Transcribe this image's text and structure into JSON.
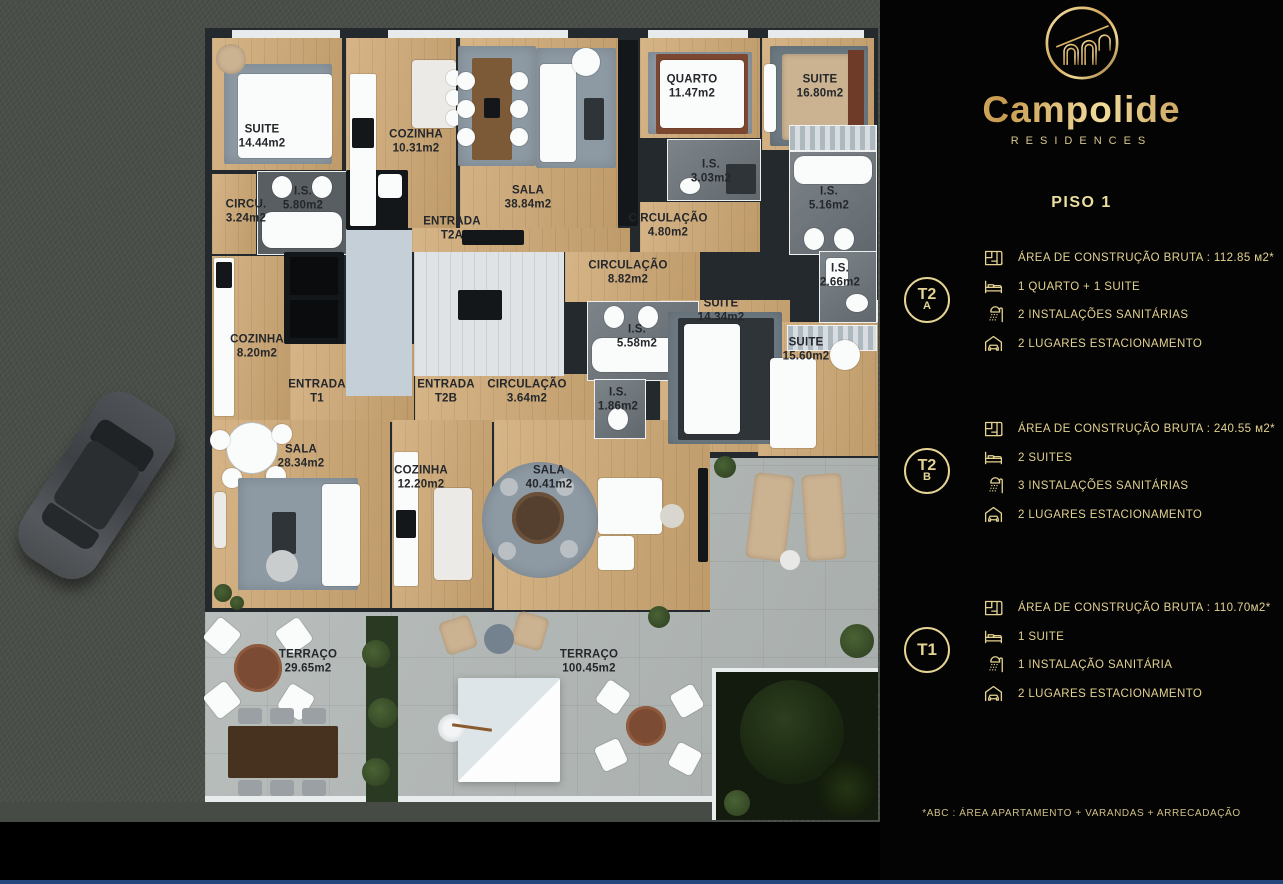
{
  "brand": {
    "name": "Campolide",
    "subtitle": "RESIDENCES",
    "logo_icon": "arches-bridge-icon",
    "accent_color": "#e5d494",
    "background_color": "#040404"
  },
  "panel": {
    "title": "PISO 1",
    "footnote": "*ABC :  ÁREA APARTAMENTO + VARANDAS + ARRECADAÇÃO",
    "units": [
      {
        "badge_line1": "T2",
        "badge_line2": "A",
        "rows": [
          {
            "icon": "floorplan-icon",
            "text": "ÁREA DE CONSTRUÇÃO BRUTA :  112.85 м2*"
          },
          {
            "icon": "bed-icon",
            "text": "1 QUARTO + 1 SUITE"
          },
          {
            "icon": "shower-icon",
            "text": "2 INSTALAÇÕES SANITÁRIAS"
          },
          {
            "icon": "garage-icon",
            "text": "2 LUGARES ESTACIONAMENTO"
          }
        ]
      },
      {
        "badge_line1": "T2",
        "badge_line2": "B",
        "rows": [
          {
            "icon": "floorplan-icon",
            "text": "ÁREA DE CONSTRUÇÃO BRUTA :  240.55 м2*"
          },
          {
            "icon": "bed-icon",
            "text": "2 SUITES"
          },
          {
            "icon": "shower-icon",
            "text": "3 INSTALAÇÕES SANITÁRIAS"
          },
          {
            "icon": "garage-icon",
            "text": "2 LUGARES ESTACIONAMENTO"
          }
        ]
      },
      {
        "badge_line1": "T1",
        "badge_line2": "",
        "rows": [
          {
            "icon": "floorplan-icon",
            "text": "ÁREA DE CONSTRUÇÃO BRUTA :  110.70м2*"
          },
          {
            "icon": "bed-icon",
            "text": "1 SUITE"
          },
          {
            "icon": "shower-icon",
            "text": "1 INSTALAÇÃO SANITÁRIA"
          },
          {
            "icon": "garage-icon",
            "text": "2 LUGARES ESTACIONAMENTO"
          }
        ]
      }
    ]
  },
  "floorplan": {
    "floor_label": "PISO 1",
    "rooms": [
      {
        "label": "SUITE",
        "area": "14.44m2",
        "x": 262,
        "y": 137
      },
      {
        "label": "COZINHA",
        "area": "10.31m2",
        "x": 416,
        "y": 142
      },
      {
        "label": "I.S.",
        "area": "5.80m2",
        "x": 303,
        "y": 199
      },
      {
        "label": "CIRCU.",
        "area": "3.24m2",
        "x": 246,
        "y": 212
      },
      {
        "label": "SALA",
        "area": "38.84m2",
        "x": 528,
        "y": 198
      },
      {
        "label": "ENTRADA",
        "area": "T2A",
        "x": 452,
        "y": 229
      },
      {
        "label": "QUARTO",
        "area": "11.47m2",
        "x": 692,
        "y": 87
      },
      {
        "label": "SUITE",
        "area": "16.80m2",
        "x": 820,
        "y": 87
      },
      {
        "label": "I.S.",
        "area": "3.03m2",
        "x": 711,
        "y": 172
      },
      {
        "label": "I.S.",
        "area": "5.16m2",
        "x": 829,
        "y": 199
      },
      {
        "label": "CIRCULAÇÃO",
        "area": "4.80m2",
        "x": 668,
        "y": 226
      },
      {
        "label": "CIRCULAÇÃO",
        "area": "8.82m2",
        "x": 628,
        "y": 273
      },
      {
        "label": "I.S.",
        "area": "2.66m2",
        "x": 840,
        "y": 276
      },
      {
        "label": "SUITE",
        "area": "14.34m2",
        "x": 721,
        "y": 311
      },
      {
        "label": "I.S.",
        "area": "5.58m2",
        "x": 637,
        "y": 337
      },
      {
        "label": "SUITE",
        "area": "15.60m2",
        "x": 806,
        "y": 350
      },
      {
        "label": "COZINHA",
        "area": "8.20m2",
        "x": 257,
        "y": 347
      },
      {
        "label": "ENTRADA",
        "area": "T1",
        "x": 317,
        "y": 392
      },
      {
        "label": "ENTRADA",
        "area": "T2B",
        "x": 446,
        "y": 392
      },
      {
        "label": "CIRCULAÇÃO",
        "area": "3.64m2",
        "x": 527,
        "y": 392
      },
      {
        "label": "I.S.",
        "area": "1.86m2",
        "x": 618,
        "y": 400
      },
      {
        "label": "SALA",
        "area": "28.34m2",
        "x": 301,
        "y": 457
      },
      {
        "label": "COZINHA",
        "area": "12.20m2",
        "x": 421,
        "y": 478
      },
      {
        "label": "SALA",
        "area": "40.41m2",
        "x": 549,
        "y": 478
      },
      {
        "label": "TERRAÇO",
        "area": "29.65m2",
        "x": 308,
        "y": 662
      },
      {
        "label": "TERRAÇO",
        "area": "100.45m2",
        "x": 589,
        "y": 662
      }
    ]
  }
}
